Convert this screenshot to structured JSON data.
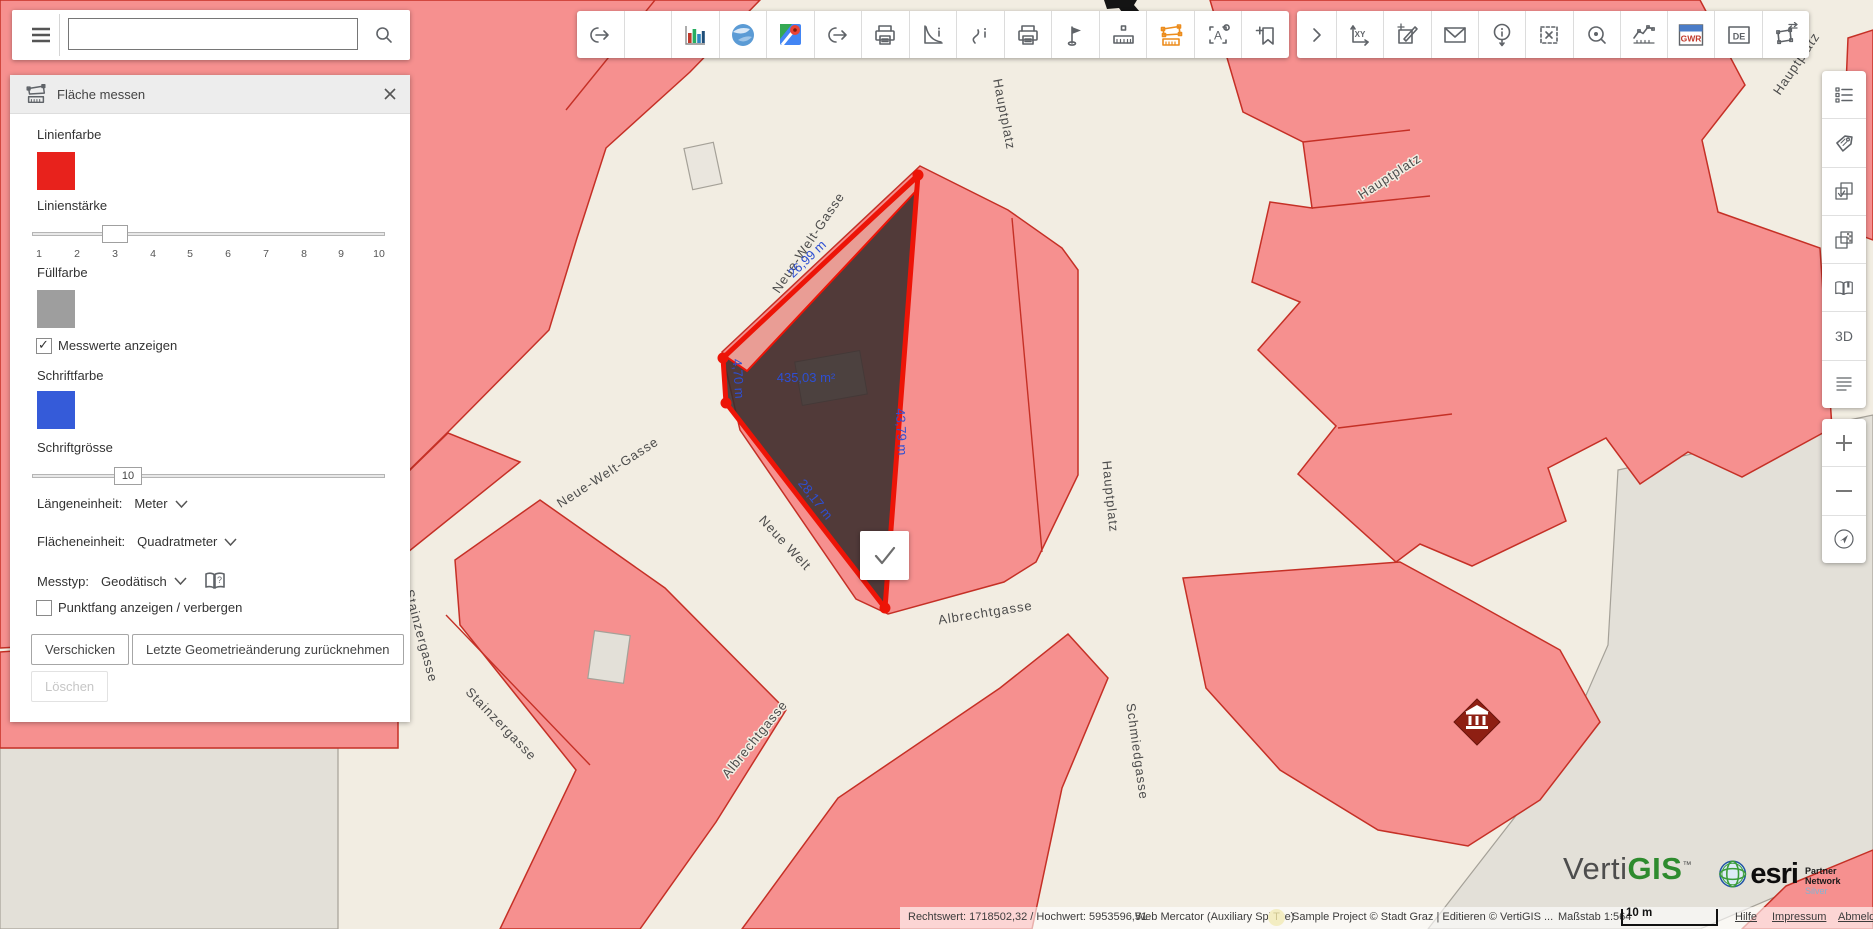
{
  "search": {
    "value": "",
    "placeholder": ""
  },
  "measure_panel": {
    "title": "Fläche messen",
    "line_color_label": "Linienfarbe",
    "line_color": "#e8221c",
    "line_width_label": "Linienstärke",
    "line_width_value": "3",
    "line_width_ticks": [
      "1",
      "2",
      "3",
      "4",
      "5",
      "6",
      "7",
      "8",
      "9",
      "10"
    ],
    "fill_color_label": "Füllfarbe",
    "fill_color": "#9e9e9e",
    "show_values_label": "Messwerte anzeigen",
    "show_values_checked": true,
    "font_color_label": "Schriftfarbe",
    "font_color": "#355bd9",
    "font_size_label": "Schriftgrösse",
    "font_size_value": "10",
    "length_unit_label": "Längeneinheit:",
    "length_unit_value": "Meter",
    "area_unit_label": "Flächeneinheit:",
    "area_unit_value": "Quadratmeter",
    "measure_type_label": "Messtyp:",
    "measure_type_value": "Geodätisch",
    "snap_label": "Punktfang anzeigen / verbergen",
    "snap_checked": false,
    "buttons": {
      "send": "Verschicken",
      "undo": "Letzte Geometrieänderung zurücknehmen",
      "delete": "Löschen"
    }
  },
  "toolbar_main_icons": [
    "export",
    "blank",
    "statistics-chart",
    "google-earth",
    "google-maps",
    "share",
    "print",
    "report-curve",
    "route-info",
    "print-alt",
    "flag",
    "measure-distance",
    "measure-area-active",
    "text-label",
    "bookmark-add"
  ],
  "toolbar_secondary_icons": [
    "expand",
    "coordinates-xy",
    "edit-geometry",
    "mail",
    "identify",
    "clear-selection",
    "zoom-selection",
    "elevation-profile",
    "gwr",
    "de",
    "transform-geometry"
  ],
  "toolbar_glyphs": {
    "xy": "XY",
    "gwr": "GWR",
    "de": "DE",
    "a": "A"
  },
  "sidebar": {
    "icons": [
      "layer-list",
      "tags",
      "selection-check",
      "transparency",
      "bookmarks-book",
      "3d",
      "legend"
    ],
    "threed_label": "3D",
    "zoom_controls": [
      "zoom-in",
      "zoom-out",
      "my-location"
    ]
  },
  "map": {
    "streets": [
      "Neue-Welt-Gasse",
      "Neue-Welt-Gasse",
      "Neue Welt",
      "Hauptplatz",
      "Hauptplatz",
      "Hauptplatz",
      "Hauptplatz",
      "Albrechtgasse",
      "Albrechtgasse",
      "Schmiedgasse",
      "Stainzergasse",
      "Stainzergasse"
    ],
    "measurement": {
      "edge_top": "26,99 m",
      "edge_left": "4,70 m",
      "edge_bottom": "28,17 m",
      "edge_right": "43,79 m",
      "area": "435,03 m²"
    }
  },
  "statusbar": {
    "coordinates": "Rechtswert: 1718502,32 / Hochwert: 5953596,51",
    "projection": "Web Mercator (Auxiliary Sphere)",
    "badge": "T",
    "copyright": "Sample Project © Stadt Graz | Editieren © VertiGIS ...",
    "scale_label": "Maßstab 1:564",
    "scalebar_label": "10 m",
    "links": [
      "Hilfe",
      "Impressum",
      "Abmelden"
    ]
  },
  "branding": {
    "vertigis_prefix": "Verti",
    "vertigis_suffix": "GIS",
    "trademark": "™",
    "esri_label": "esri",
    "partner_label": "Partner Network",
    "partner_tier": "Silver"
  }
}
